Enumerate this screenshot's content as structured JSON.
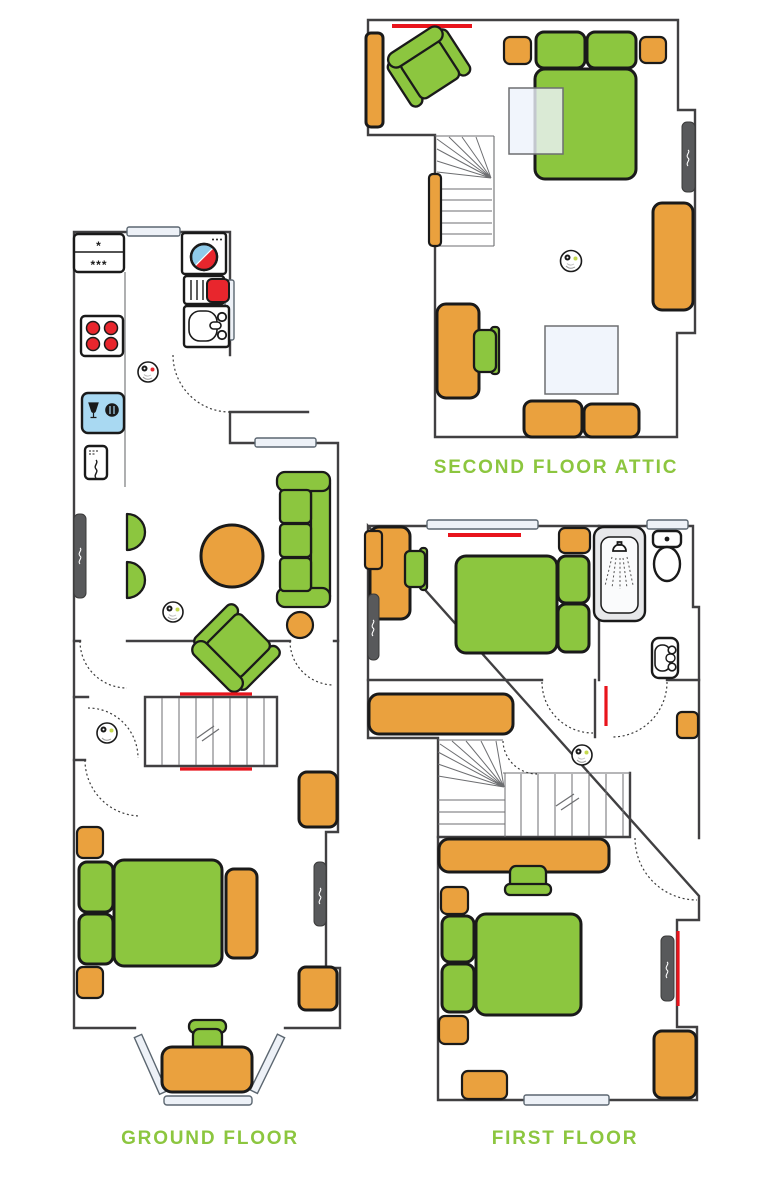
{
  "document": {
    "type": "house-floor-plan",
    "background": "#FFFFFF"
  },
  "floors": {
    "second_floor_attic": {
      "label": "SECOND FLOOR ATTIC",
      "furniture": [
        "wardrobe",
        "armchair",
        "double-bed",
        "nightstand",
        "nightstand",
        "skylight",
        "skylight",
        "radiator",
        "winder-stairs",
        "desk",
        "desk-chair",
        "smoke-detector",
        "storage-seat",
        "storage-seat",
        "tall-wardrobe"
      ]
    },
    "ground_floor": {
      "label": "GROUND FLOOR",
      "rooms": [
        "kitchen",
        "living-room",
        "hallway",
        "bedroom",
        "bay-window"
      ],
      "furniture": [
        "fridge-freezer",
        "hob",
        "dishwasher",
        "microwave",
        "washing-machine",
        "boiler",
        "sink",
        "radiator",
        "half-round-chair",
        "half-round-chair",
        "round-table",
        "sofa",
        "pouffe",
        "armchair",
        "stairs",
        "double-bed",
        "nightstand",
        "nightstand",
        "bedside-bench",
        "radiator",
        "corner-cabinet",
        "desk",
        "desk-chair",
        "hall-cabinet"
      ]
    },
    "first_floor": {
      "label": "FIRST FLOOR",
      "rooms": [
        "bedroom-1",
        "shower-room",
        "landing",
        "bedroom-2"
      ],
      "furniture": [
        "desk",
        "desk-chair",
        "radiator",
        "double-bed",
        "nightstand",
        "shower",
        "toilet",
        "basin",
        "wardrobe",
        "smoke-detector",
        "stairs",
        "desk",
        "desk-chair",
        "nightstand",
        "double-bed",
        "nightstand",
        "chest",
        "wardrobe",
        "radiator"
      ]
    }
  },
  "kitchen_appliances": {
    "fridge_star_top": "*",
    "fridge_star_bottom": "***"
  },
  "colors": {
    "furniture_green": "#8CC63F",
    "furniture_orange": "#EAA13E",
    "accent_red": "#E8141C",
    "appliance_red": "#E8262D",
    "washer_blue": "#8FCBEA",
    "dishwasher_blue": "#A9D9F2",
    "radiator_grey": "#58595B",
    "window_fill": "#EDF1F7",
    "wall_grey": "#414042",
    "label_green": "#8CC63F",
    "skylight_blue": "#EDF2FB"
  }
}
